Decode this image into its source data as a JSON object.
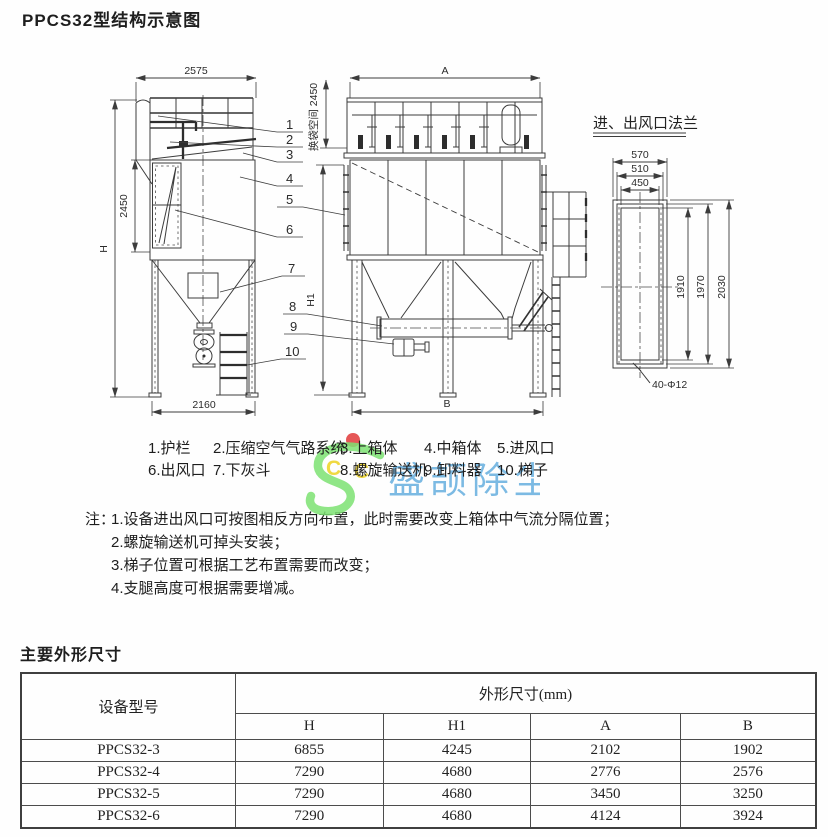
{
  "header": {
    "title": "PPCS32型结构示意图"
  },
  "diagram": {
    "dims": {
      "w_top_left": "2575",
      "h_body_left": "2450",
      "h_total": "H",
      "w_bottom_left": "2160",
      "w_top_mid": "A",
      "bag_space": "换袋空间 2450",
      "h1": "H1",
      "w_bottom_mid": "B"
    },
    "flange": {
      "title": "进、出风口法兰",
      "w_outer": "570",
      "w_mid": "510",
      "w_inner": "450",
      "h_inner": "1910",
      "h_mid": "1970",
      "h_outer": "2030",
      "holes": "40-Φ12"
    },
    "callouts": {
      "c1": "1",
      "c2": "2",
      "c3": "3",
      "c4": "4",
      "c5": "5",
      "c6": "6",
      "c7": "7",
      "c8": "8",
      "c9": "9",
      "c10": "10"
    },
    "watermark": {
      "text": "盛颉除尘",
      "c_left": "C",
      "c_right": "C"
    }
  },
  "parts": {
    "row1": [
      "1.护栏",
      "2.压缩空气气路系统",
      "3.上箱体",
      "4.中箱体",
      "5.进风口"
    ],
    "row2": [
      "6.出风口",
      "7.下灰斗",
      "8.螺旋输送机",
      "9.卸料器",
      "10.梯子"
    ]
  },
  "notes": {
    "label": "注：",
    "lines": [
      "1.设备进出风口可按图相反方向布置，此时需要改变上箱体中气流分隔位置；",
      "2.螺旋输送机可掉头安装；",
      "3.梯子位置可根据工艺布置需要而改变；",
      "4.支腿高度可根据需要增减。"
    ]
  },
  "dimensions_section": {
    "title": "主要外形尺寸",
    "table": {
      "col_model": "设备型号",
      "col_group": "外形尺寸(mm)",
      "columns": [
        "H",
        "H1",
        "A",
        "B"
      ],
      "rows": [
        {
          "model": "PPCS32-3",
          "h": "6855",
          "h1": "4245",
          "a": "2102",
          "b": "1902"
        },
        {
          "model": "PPCS32-4",
          "h": "7290",
          "h1": "4680",
          "a": "2776",
          "b": "2576"
        },
        {
          "model": "PPCS32-5",
          "h": "7290",
          "h1": "4680",
          "a": "3450",
          "b": "3250"
        },
        {
          "model": "PPCS32-6",
          "h": "7290",
          "h1": "4680",
          "a": "4124",
          "b": "3924"
        }
      ]
    }
  },
  "colors": {
    "line": "#3c3c3c",
    "watermark_green": "#7de272",
    "watermark_blue": "#58a7dc",
    "watermark_yellow": "#f0d838",
    "watermark_red": "#e24444"
  }
}
